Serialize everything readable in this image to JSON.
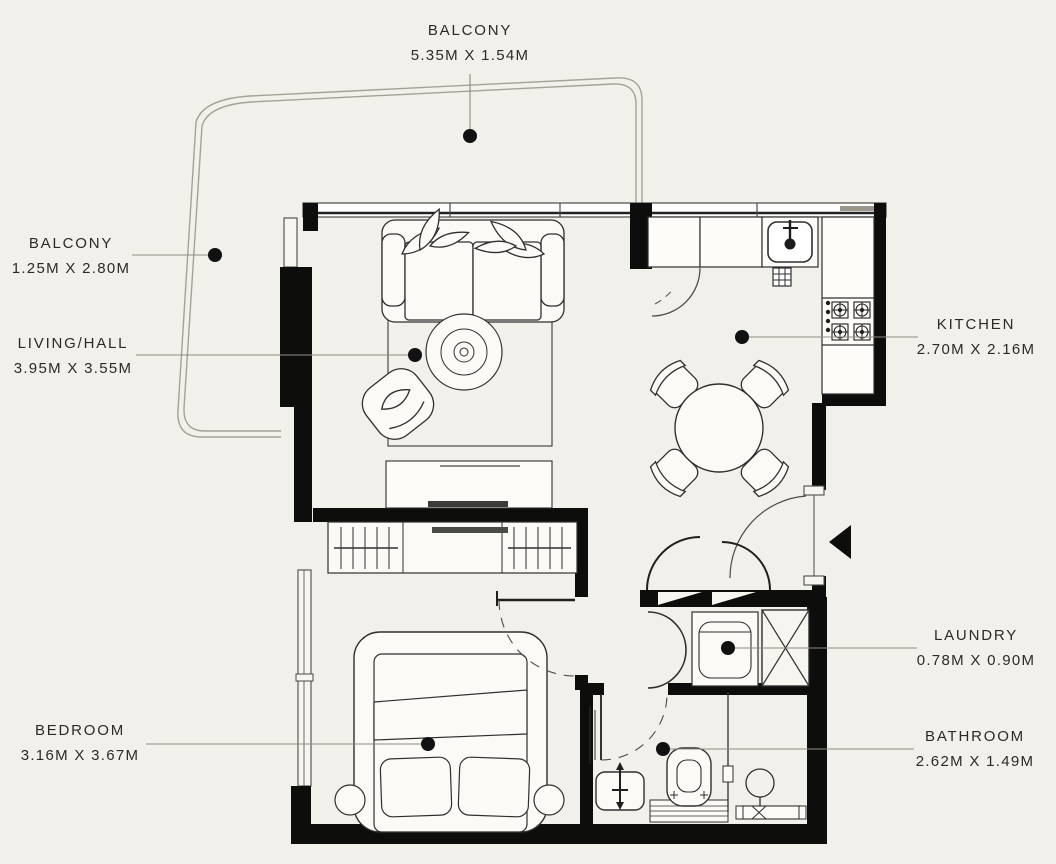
{
  "title": "Apartment floor plan",
  "colors": {
    "background": "#f2f0ea",
    "walls": "#0d0d0c",
    "furniture_line": "#2f2f2e",
    "balcony_line": "#a5a197",
    "leader_line": "#8f8b81",
    "label_text": "#2a2a28",
    "marker_dot": "#111111"
  },
  "labels": {
    "balcony_top": {
      "room": "BALCONY",
      "dims": "5.35M X 1.54M"
    },
    "balcony_left": {
      "room": "BALCONY",
      "dims": "1.25M X 2.80M"
    },
    "living_hall": {
      "room": "LIVING/HALL",
      "dims": "3.95M X 3.55M"
    },
    "kitchen": {
      "room": "KITCHEN",
      "dims": "2.70M X 2.16M"
    },
    "laundry": {
      "room": "LAUNDRY",
      "dims": "0.78M X 0.90M"
    },
    "bathroom": {
      "room": "BATHROOM",
      "dims": "2.62M X 1.49M"
    },
    "bedroom": {
      "room": "BEDROOM",
      "dims": "3.16M X 3.67M"
    }
  }
}
